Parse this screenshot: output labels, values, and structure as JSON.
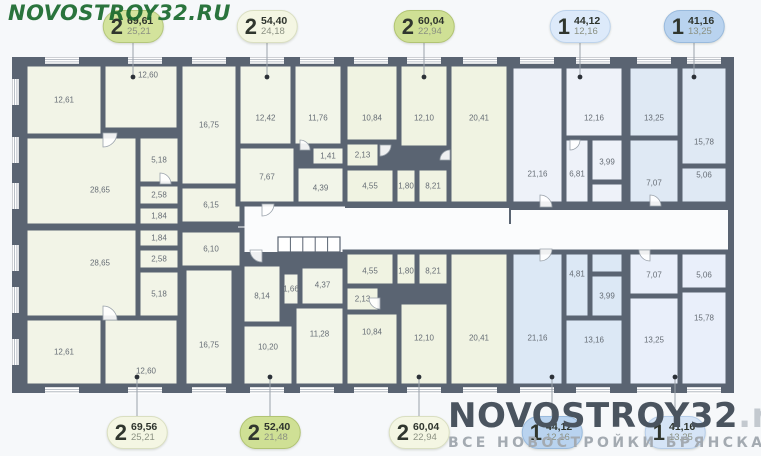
{
  "canvas": {
    "w": 761,
    "h": 456,
    "bg": "#f6f8fa"
  },
  "colors": {
    "wall": "#5a6472",
    "corridor": "#fbfcfd",
    "window_fill": "#ffffff",
    "window_line": "#a8afb8",
    "leader": "#9aa2ab",
    "dot": "#2c3138",
    "door_stroke": "#9aa2ab"
  },
  "watermark_top": {
    "text": "NOVOSTROY32.RU"
  },
  "watermark_bottom": {
    "title": "NOVOSTROY32",
    "suffix": ".ru",
    "subtitle": "ВСЕ НОВОСТРОЙКИ БРЯНСКА"
  },
  "badges": {
    "top": [
      {
        "type": "2",
        "area": "69,61",
        "living": "25,21",
        "cx": 133,
        "bg": "#d3e39c",
        "border": "#b4c77b"
      },
      {
        "type": "2",
        "area": "54,40",
        "living": "24,18",
        "cx": 267,
        "bg": "#f4f6e3",
        "border": "#dadfc1"
      },
      {
        "type": "2",
        "area": "60,04",
        "living": "22,94",
        "cx": 424,
        "bg": "#cfe095",
        "border": "#b1c473"
      },
      {
        "type": "1",
        "area": "44,12",
        "living": "12,16",
        "cx": 580,
        "bg": "#ddeafa",
        "border": "#bdd3ec"
      },
      {
        "type": "1",
        "area": "41,16",
        "living": "13,25",
        "cx": 694,
        "bg": "#b9d3ef",
        "border": "#99badd"
      }
    ],
    "bottom": [
      {
        "type": "2",
        "area": "69,56",
        "living": "25,21",
        "cx": 137,
        "bg": "#f4f6e3",
        "border": "#dadfc1"
      },
      {
        "type": "2",
        "area": "52,40",
        "living": "21,48",
        "cx": 270,
        "bg": "#cfe095",
        "border": "#b1c473"
      },
      {
        "type": "2",
        "area": "60,04",
        "living": "22,94",
        "cx": 419,
        "bg": "#f4f6e3",
        "border": "#dadfc1"
      },
      {
        "type": "1",
        "area": "44,12",
        "living": "12,16",
        "cx": 552,
        "bg": "#b9d3ef",
        "border": "#99badd"
      },
      {
        "type": "1",
        "area": "41,16",
        "living": "13,25",
        "cx": 675,
        "bg": "#d5e4f6",
        "border": "#b6cde9"
      }
    ]
  },
  "plan": {
    "outline": {
      "x": 12,
      "y": 57,
      "w": 722,
      "h": 336
    },
    "corridor": [
      {
        "x": 238,
        "y": 224,
        "w": 490,
        "h": 28
      },
      {
        "x": 238,
        "y": 200,
        "w": 107,
        "h": 52
      },
      {
        "x": 345,
        "y": 208,
        "w": 164,
        "h": 44
      },
      {
        "x": 511,
        "y": 210,
        "w": 217,
        "h": 42
      }
    ],
    "stairs": {
      "x": 278,
      "y": 237,
      "w": 62,
      "h": 15,
      "steps": 5
    },
    "apartments": [
      {
        "id": "apt-top-1",
        "type": "2",
        "fill": "#f2f4e7",
        "rooms": [
          {
            "label": "12,61",
            "x": 25,
            "y": 64,
            "w": 78,
            "h": 72
          },
          {
            "label": "12,60",
            "x": 103,
            "y": 64,
            "w": 76,
            "h": 66,
            "lx": 148,
            "ly": 75
          },
          {
            "label": "28,65",
            "x": 25,
            "y": 136,
            "w": 113,
            "h": 90,
            "lx": 100,
            "ly": 190
          },
          {
            "label": "5,18",
            "x": 138,
            "y": 136,
            "w": 42,
            "h": 48
          },
          {
            "label": "2,58",
            "x": 138,
            "y": 184,
            "w": 42,
            "h": 22
          },
          {
            "label": "1,84",
            "x": 138,
            "y": 206,
            "w": 42,
            "h": 20
          },
          {
            "label": "6,15",
            "x": 180,
            "y": 186,
            "w": 62,
            "h": 38
          }
        ]
      },
      {
        "id": "apt-top-2",
        "type": "2",
        "fill": "#f2f5e9",
        "rooms": [
          {
            "label": "16,75",
            "x": 180,
            "y": 64,
            "w": 58,
            "h": 122
          },
          {
            "label": "12,42",
            "x": 238,
            "y": 64,
            "w": 55,
            "h": 82,
            "ly": 118
          },
          {
            "label": "11,76",
            "x": 293,
            "y": 64,
            "w": 50,
            "h": 82,
            "ly": 118
          },
          {
            "label": "7,67",
            "x": 238,
            "y": 146,
            "w": 58,
            "h": 58,
            "ly": 177
          },
          {
            "label": "1,41",
            "x": 311,
            "y": 146,
            "w": 34,
            "h": 20
          },
          {
            "label": "4,39",
            "x": 296,
            "y": 166,
            "w": 49,
            "h": 38,
            "ly": 188
          }
        ]
      },
      {
        "id": "apt-top-3",
        "type": "2",
        "fill": "#f0f3e2",
        "rooms": [
          {
            "label": "10,84",
            "x": 345,
            "y": 64,
            "w": 54,
            "h": 78,
            "ly": 118
          },
          {
            "label": "12,10",
            "x": 399,
            "y": 64,
            "w": 50,
            "h": 84,
            "ly": 118
          },
          {
            "label": "20,41",
            "x": 449,
            "y": 64,
            "w": 60,
            "h": 140,
            "ly": 118
          },
          {
            "label": "2,13",
            "x": 345,
            "y": 142,
            "w": 35,
            "h": 26
          },
          {
            "label": "4,55",
            "x": 345,
            "y": 168,
            "w": 50,
            "h": 36,
            "ly": 186
          },
          {
            "label": "1,80",
            "x": 395,
            "y": 168,
            "w": 22,
            "h": 36,
            "ly": 186
          },
          {
            "label": "8,21",
            "x": 417,
            "y": 168,
            "w": 32,
            "h": 36,
            "ly": 186
          }
        ]
      },
      {
        "id": "apt-top-4",
        "type": "1",
        "fill": "#eef2f9",
        "rooms": [
          {
            "label": "21,16",
            "x": 511,
            "y": 66,
            "w": 53,
            "h": 138,
            "ly": 174
          },
          {
            "label": "12,16",
            "x": 564,
            "y": 66,
            "w": 60,
            "h": 72,
            "ly": 118
          },
          {
            "label": "",
            "x": 564,
            "y": 182,
            "w": 60,
            "h": 22
          },
          {
            "label": "6,81",
            "x": 564,
            "y": 138,
            "w": 26,
            "h": 66,
            "ly": 174
          },
          {
            "label": "3,99",
            "x": 590,
            "y": 138,
            "w": 34,
            "h": 44,
            "ly": 162
          }
        ]
      },
      {
        "id": "apt-top-5",
        "type": "1",
        "fill": "#dfe9f4",
        "rooms": [
          {
            "label": "13,25",
            "x": 628,
            "y": 66,
            "w": 52,
            "h": 72,
            "ly": 118
          },
          {
            "label": "15,78",
            "x": 680,
            "y": 66,
            "w": 48,
            "h": 100,
            "ly": 142
          },
          {
            "label": "7,07",
            "x": 628,
            "y": 138,
            "w": 52,
            "h": 66,
            "ly": 183
          },
          {
            "label": "5,06",
            "x": 680,
            "y": 166,
            "w": 48,
            "h": 38,
            "ly": 175
          }
        ]
      },
      {
        "id": "apt-bottom-1",
        "type": "2",
        "fill": "#f2f4e7",
        "rooms": [
          {
            "label": "28,65",
            "x": 25,
            "y": 228,
            "w": 113,
            "h": 90,
            "lx": 100,
            "ly": 263
          },
          {
            "label": "1,84",
            "x": 138,
            "y": 228,
            "w": 42,
            "h": 20
          },
          {
            "label": "2,58",
            "x": 138,
            "y": 248,
            "w": 42,
            "h": 22
          },
          {
            "label": "5,18",
            "x": 138,
            "y": 270,
            "w": 42,
            "h": 48
          },
          {
            "label": "12,61",
            "x": 25,
            "y": 318,
            "w": 78,
            "h": 68
          },
          {
            "label": "12,60",
            "x": 103,
            "y": 318,
            "w": 76,
            "h": 68,
            "lx": 146,
            "ly": 371
          },
          {
            "label": "6,10",
            "x": 180,
            "y": 230,
            "w": 62,
            "h": 38
          }
        ]
      },
      {
        "id": "apt-bottom-2",
        "type": "2",
        "fill": "#f2f5e9",
        "rooms": [
          {
            "label": "16,75",
            "x": 184,
            "y": 268,
            "w": 50,
            "h": 118,
            "ly": 345
          },
          {
            "label": "8,14",
            "x": 242,
            "y": 264,
            "w": 40,
            "h": 60,
            "ly": 296
          },
          {
            "label": "1,66",
            "x": 282,
            "y": 272,
            "w": 18,
            "h": 34
          },
          {
            "label": "4,37",
            "x": 300,
            "y": 266,
            "w": 45,
            "h": 40,
            "ly": 285
          },
          {
            "label": "10,20",
            "x": 242,
            "y": 324,
            "w": 52,
            "h": 62,
            "ly": 347
          },
          {
            "label": "11,28",
            "x": 294,
            "y": 306,
            "w": 51,
            "h": 80,
            "ly": 334
          }
        ]
      },
      {
        "id": "apt-bottom-3",
        "type": "2",
        "fill": "#f0f3e2",
        "rooms": [
          {
            "label": "4,55",
            "x": 345,
            "y": 252,
            "w": 50,
            "h": 34,
            "ly": 271
          },
          {
            "label": "1,80",
            "x": 395,
            "y": 252,
            "w": 22,
            "h": 34,
            "ly": 271
          },
          {
            "label": "8,21",
            "x": 417,
            "y": 252,
            "w": 32,
            "h": 34,
            "ly": 271
          },
          {
            "label": "2,13",
            "x": 345,
            "y": 286,
            "w": 35,
            "h": 26
          },
          {
            "label": "10,84",
            "x": 345,
            "y": 312,
            "w": 54,
            "h": 74,
            "ly": 332
          },
          {
            "label": "12,10",
            "x": 399,
            "y": 302,
            "w": 50,
            "h": 84,
            "ly": 338
          },
          {
            "label": "20,41",
            "x": 449,
            "y": 252,
            "w": 60,
            "h": 134,
            "ly": 338
          }
        ]
      },
      {
        "id": "apt-bottom-4",
        "type": "1",
        "fill": "#dce8f5",
        "rooms": [
          {
            "label": "21,16",
            "x": 511,
            "y": 252,
            "w": 53,
            "h": 134,
            "ly": 338
          },
          {
            "label": "",
            "x": 564,
            "y": 252,
            "w": 60,
            "h": 22
          },
          {
            "label": "4,81",
            "x": 564,
            "y": 252,
            "w": 26,
            "h": 66,
            "ly": 274
          },
          {
            "label": "3,99",
            "x": 590,
            "y": 274,
            "w": 34,
            "h": 44,
            "ly": 296
          },
          {
            "label": "13,16",
            "x": 564,
            "y": 318,
            "w": 60,
            "h": 68,
            "ly": 340
          }
        ]
      },
      {
        "id": "apt-bottom-5",
        "type": "1",
        "fill": "#e9effa",
        "rooms": [
          {
            "label": "7,07",
            "x": 628,
            "y": 252,
            "w": 52,
            "h": 44,
            "ly": 275
          },
          {
            "label": "5,06",
            "x": 680,
            "y": 252,
            "w": 48,
            "h": 38,
            "ly": 275
          },
          {
            "label": "13,25",
            "x": 628,
            "y": 296,
            "w": 52,
            "h": 90,
            "ly": 340
          },
          {
            "label": "15,78",
            "x": 680,
            "y": 290,
            "w": 48,
            "h": 96,
            "ly": 318
          }
        ]
      }
    ],
    "windows": {
      "top": [
        62,
        145,
        209,
        267,
        317,
        371,
        424,
        480,
        537,
        593,
        654,
        704
      ],
      "bottom": [
        62,
        145,
        209,
        267,
        317,
        371,
        424,
        480,
        537,
        593,
        654,
        704
      ],
      "left": [
        92,
        150,
        196,
        258,
        300,
        352
      ]
    },
    "doors": [
      {
        "x": 103,
        "y": 133,
        "r": 14,
        "rot": 90
      },
      {
        "x": 160,
        "y": 184,
        "r": 11,
        "rot": 0
      },
      {
        "x": 262,
        "y": 204,
        "r": 12,
        "rot": 90
      },
      {
        "x": 300,
        "y": 150,
        "r": 10,
        "rot": 0
      },
      {
        "x": 380,
        "y": 145,
        "r": 11,
        "rot": 90
      },
      {
        "x": 450,
        "y": 160,
        "r": 10,
        "rot": 270
      },
      {
        "x": 540,
        "y": 207,
        "r": 12,
        "rot": 0
      },
      {
        "x": 570,
        "y": 140,
        "r": 10,
        "rot": 90
      },
      {
        "x": 650,
        "y": 206,
        "r": 11,
        "rot": 0
      },
      {
        "x": 103,
        "y": 320,
        "r": 14,
        "rot": 0
      },
      {
        "x": 262,
        "y": 250,
        "r": 12,
        "rot": 180
      },
      {
        "x": 380,
        "y": 298,
        "r": 11,
        "rot": 180
      },
      {
        "x": 540,
        "y": 249,
        "r": 12,
        "rot": 90
      },
      {
        "x": 650,
        "y": 250,
        "r": 11,
        "rot": 180
      }
    ],
    "entry_dots": {
      "top": [
        133,
        267,
        424,
        580,
        694
      ],
      "bottom": [
        137,
        270,
        419,
        552,
        675
      ]
    }
  }
}
